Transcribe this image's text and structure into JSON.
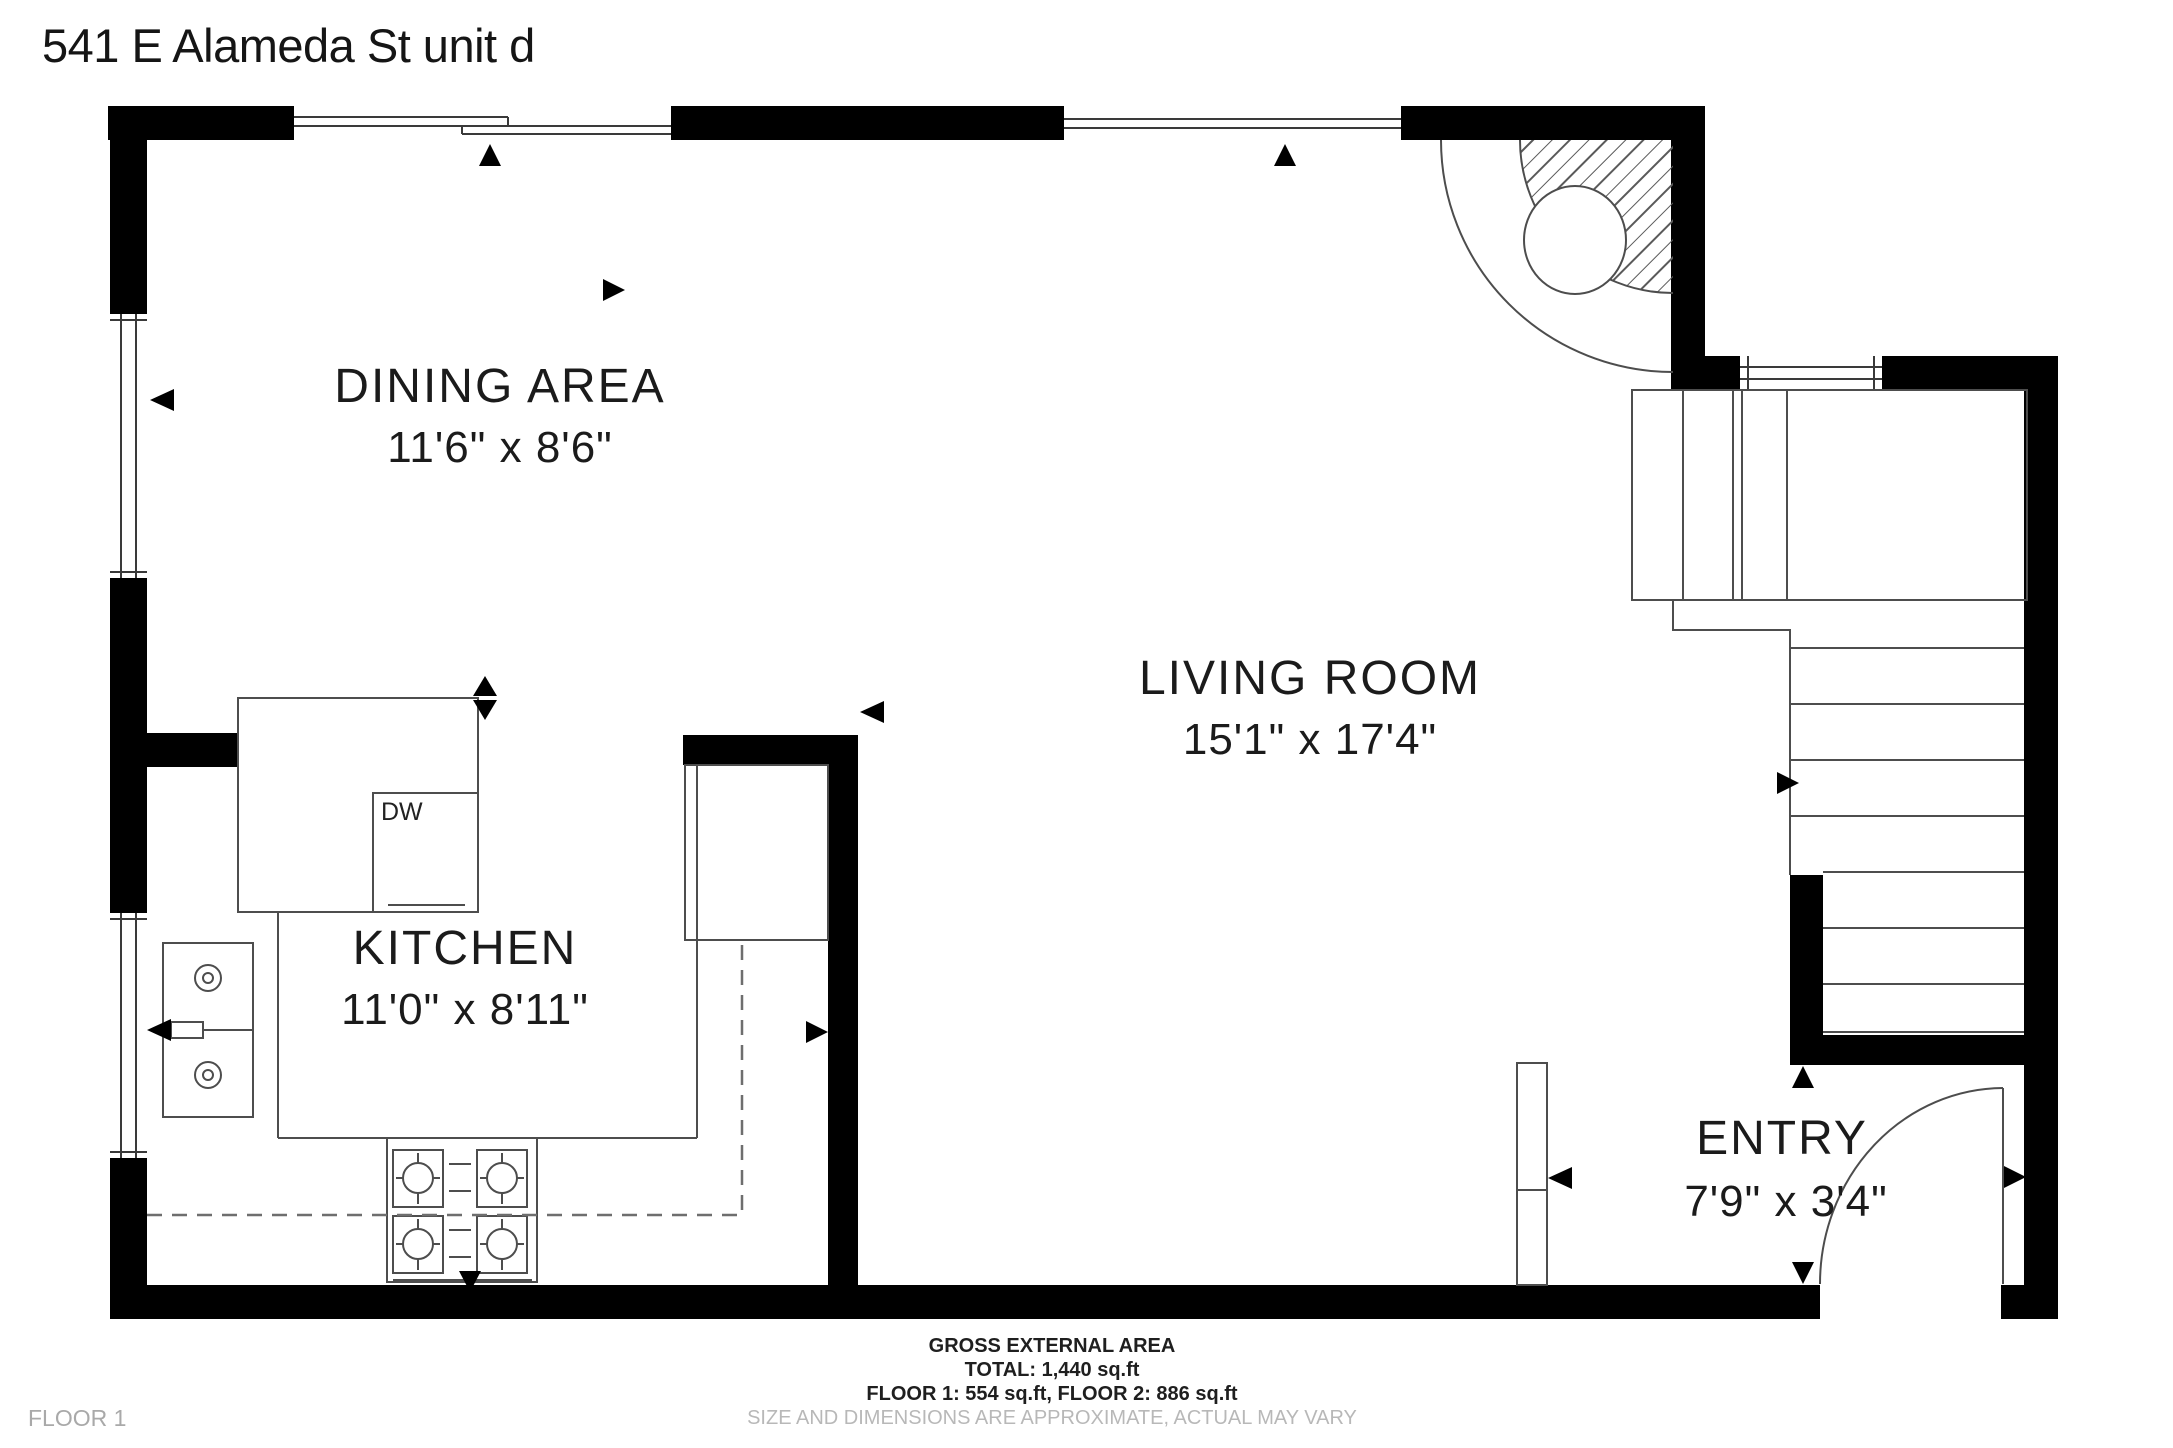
{
  "title": "541 E Alameda St unit d",
  "floor_label": "FLOOR 1",
  "rooms": [
    {
      "name": "DINING AREA",
      "dims": "11'6\" x 8'6\""
    },
    {
      "name": "LIVING ROOM",
      "dims": "15'1\" x 17'4\""
    },
    {
      "name": "KITCHEN",
      "dims": "11'0\" x 8'11\""
    },
    {
      "name": "ENTRY",
      "dims": "7'9\" x 3'4\""
    }
  ],
  "appliances": {
    "dishwasher": "DW"
  },
  "footer": {
    "area_title": "GROSS EXTERNAL AREA",
    "total": "TOTAL: 1,440 sq.ft",
    "floors": "FLOOR 1: 554 sq.ft, FLOOR 2: 886 sq.ft",
    "disclaimer": "SIZE AND DIMENSIONS ARE APPROXIMATE, ACTUAL MAY VARY"
  },
  "colors": {
    "wall": "#000000",
    "line": "#4d4d4d",
    "text": "#1a1a1a",
    "muted": "#b8b8b8"
  }
}
